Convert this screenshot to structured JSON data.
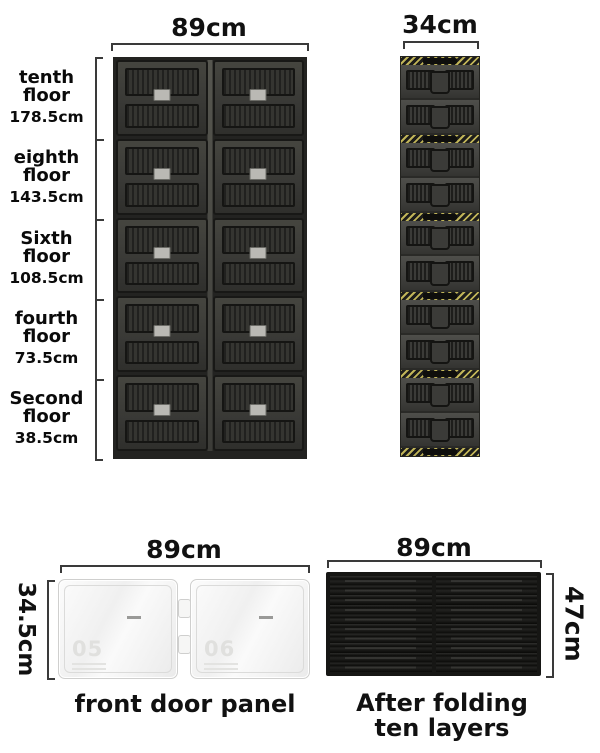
{
  "cabinet": {
    "width_label": "89cm",
    "rows": 5,
    "cols": 2,
    "floors": [
      {
        "name": "tenth floor",
        "height": "178.5cm"
      },
      {
        "name": "eighth floor",
        "height": "143.5cm"
      },
      {
        "name": "Sixth floor",
        "height": "108.5cm"
      },
      {
        "name": "fourth floor",
        "height": "73.5cm"
      },
      {
        "name": "Second floor",
        "height": "38.5cm"
      }
    ]
  },
  "folded_column": {
    "width_label": "34cm",
    "modules": 5,
    "panels_per_module": 2
  },
  "door_panel": {
    "width_label": "89cm",
    "height_label": "34.5cm",
    "caption": "front door panel",
    "leaf_marks": [
      "05",
      "06"
    ]
  },
  "folded_stack": {
    "width_label": "89cm",
    "height_label": "47cm",
    "caption_line1": "After folding",
    "caption_line2": "ten layers",
    "layers": 10
  },
  "colors": {
    "background": "#ffffff",
    "text": "#111111",
    "cabinet_body": "#3a3a37",
    "cabinet_frame": "#181816",
    "hazard_yellow": "#c0b458",
    "stack_black": "#161614",
    "door_white": "#f5f5f4",
    "dimension_line": "#3a3a3a"
  }
}
